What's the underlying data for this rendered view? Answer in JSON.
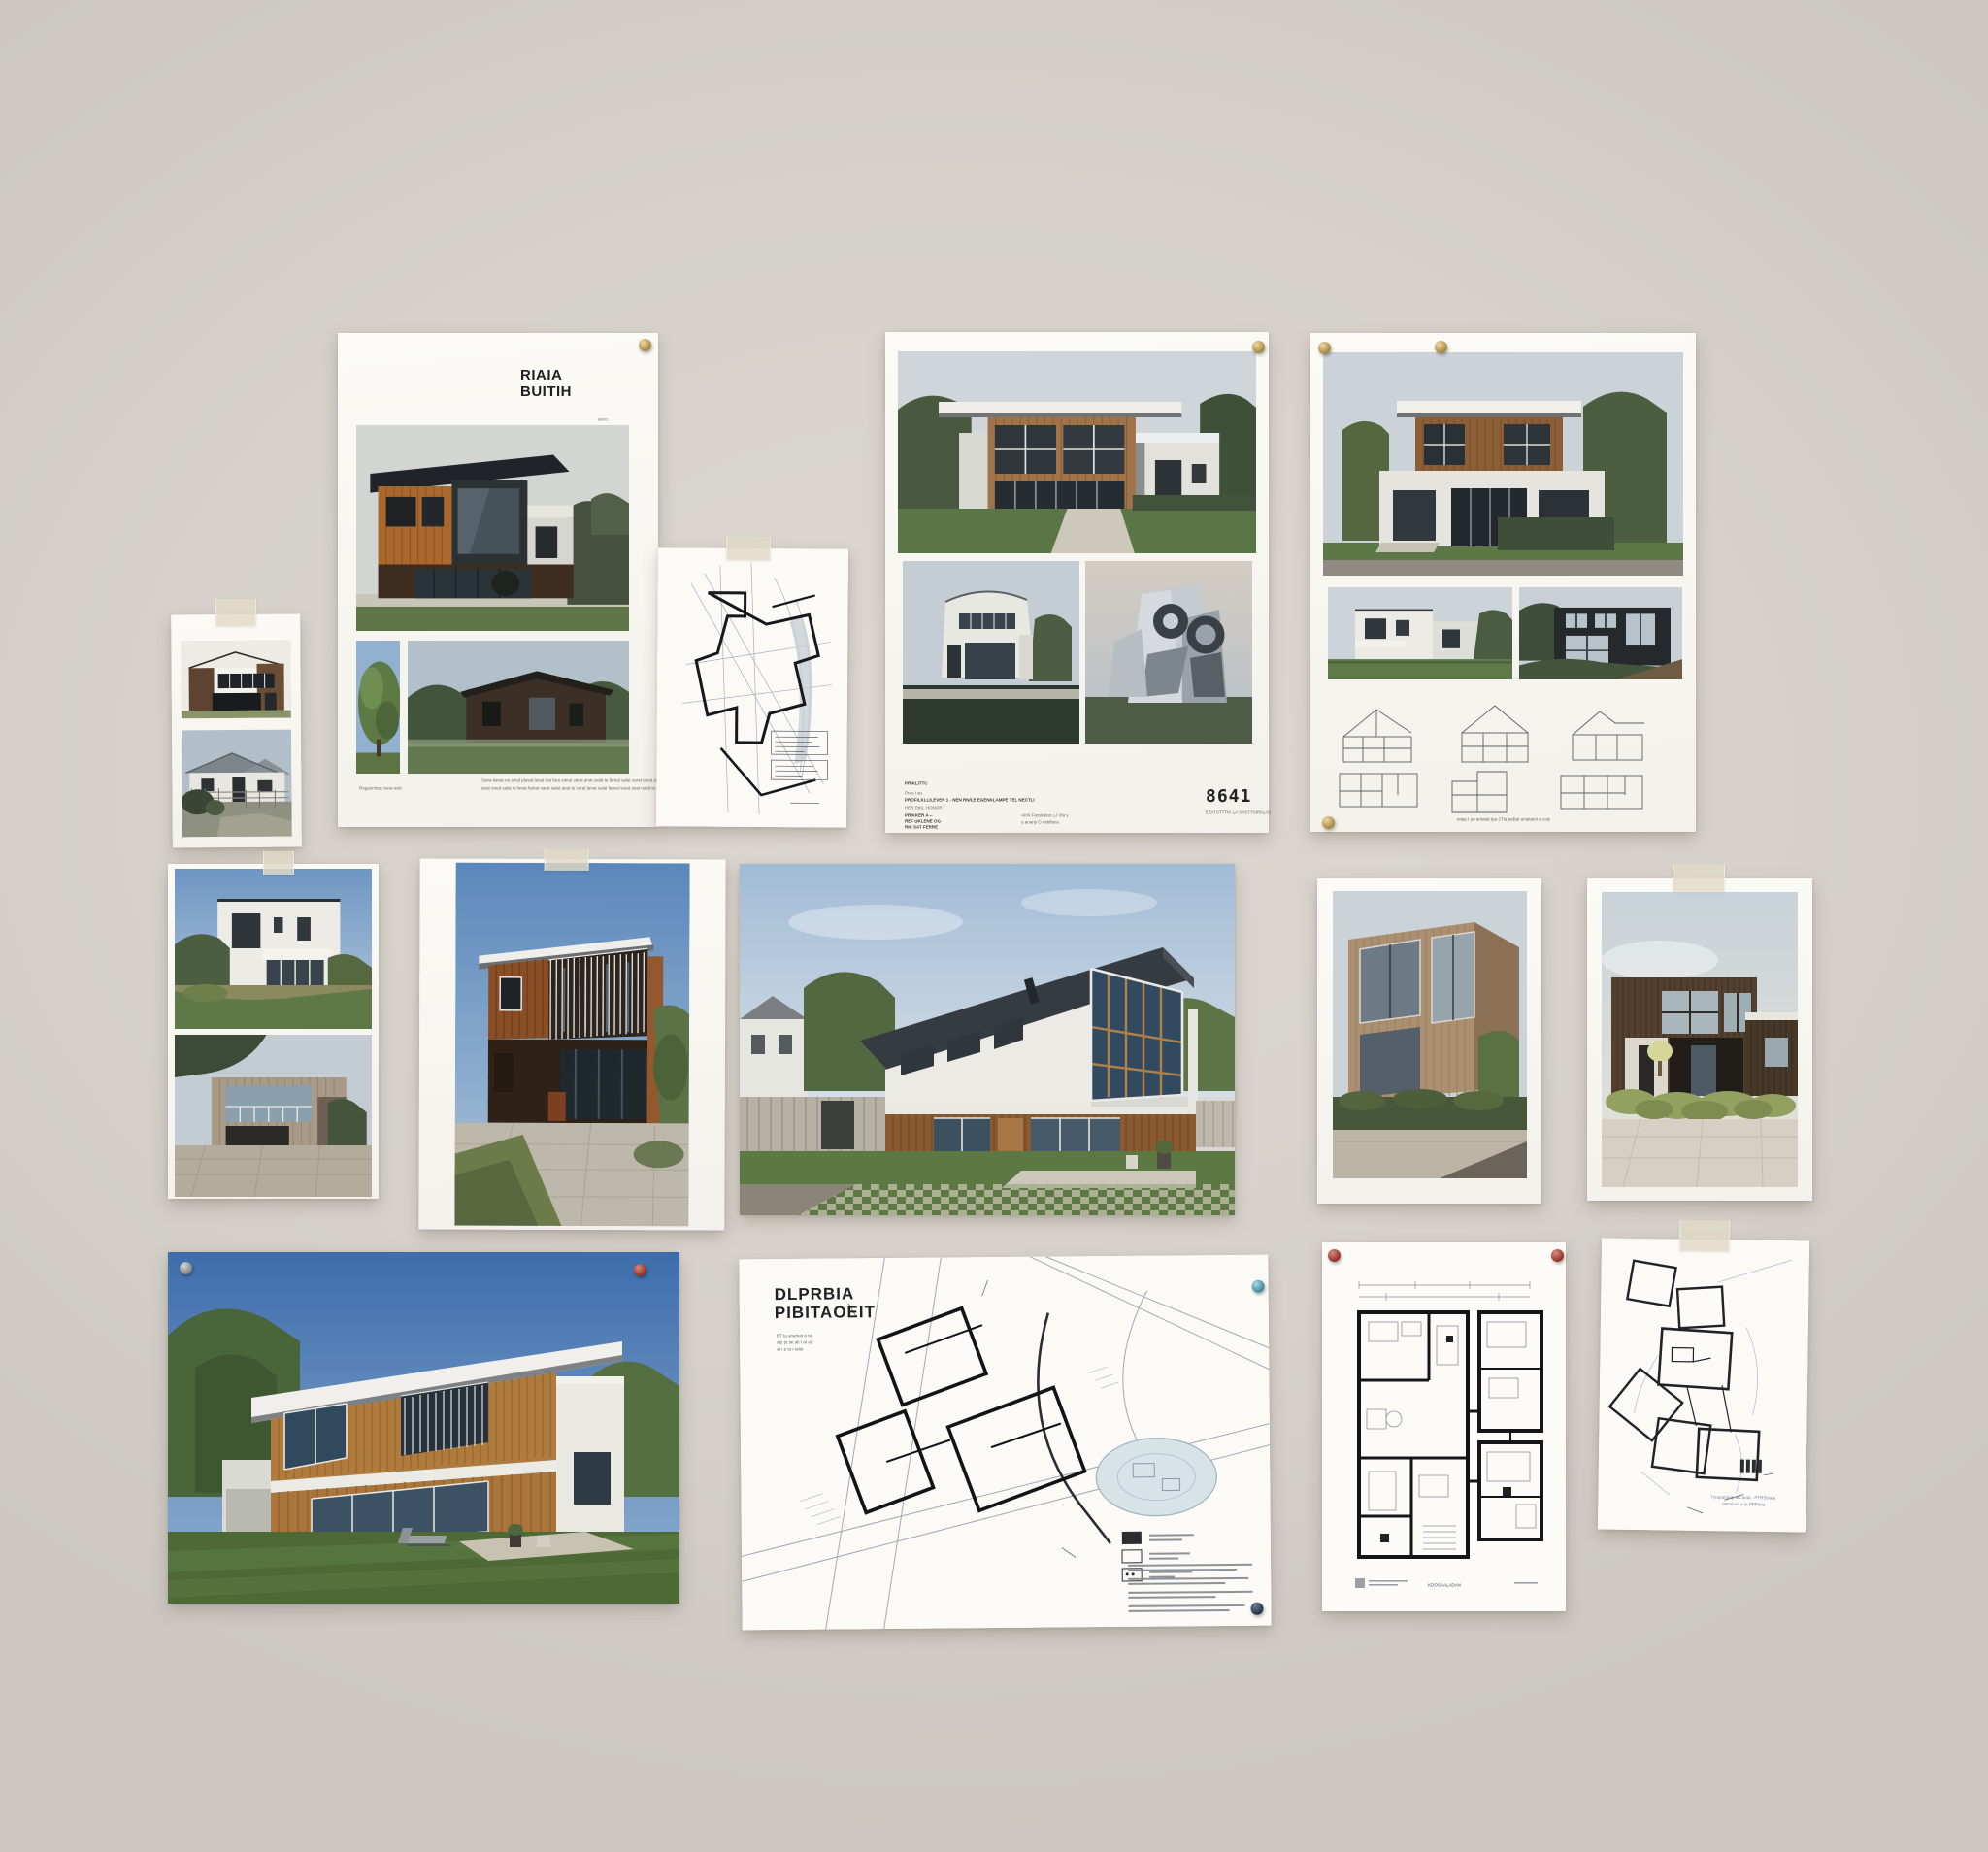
{
  "wall": {
    "color": "#d6d2cb"
  },
  "portfolio_poster": {
    "title_line1": "RIAIA",
    "title_line2": "BUITIH",
    "subtext_line1": "anco",
    "subtext_line2": "cecxu",
    "caption": "Rogaernteg vana-sstv",
    "fineprint_line1": "Sana kanat na antal plasat lanat trat fara vanat varat anat salat te famat salat varat tanat anat varat",
    "fineprint_line2": "anat varat salat te lanat famat varat salat anat te varat lanat salat famat varat anat nalat te varat"
  },
  "spec_sheet": {
    "heading": "PRIKLITTC",
    "line1": "Prau i au",
    "line2": "PROFILKLLILEVEN 1  -  NEN RN/LE EGENKLAMPE TEL NECTLI",
    "line3": "HER RIKL HONOR",
    "line4": "PRIKKER A --",
    "line5": "REF UKLENE OG",
    "line6": "RIK SAT FERRE",
    "col2_line1": "AKN Fanskalan LJ Vla v.",
    "col2_line2": "u anany O nekflanu",
    "number": "8641",
    "number_caption": "ETATSTTTIK LA SASTTSIRIILAS"
  },
  "plans_poster": {
    "caption": "tatap t pa antatat tpa 2Tta aaBat antatatvt a coty"
  },
  "site_plan": {
    "title_line1": "DLPRBIA",
    "title_line2": "PIBITAOEIT",
    "note_line1": "BT ta anamat a na",
    "note_line2": "atp pt tat alt t at a2",
    "note_line3": "at t p ta t talat"
  },
  "floor_plan": {
    "caption": "KDOSAALADAN"
  },
  "massing_sketch": {
    "caption_line1": "Tyroparatap tttv avta - PTRStvata",
    "caption_line2": "tatttataat a ta PPPtata"
  }
}
